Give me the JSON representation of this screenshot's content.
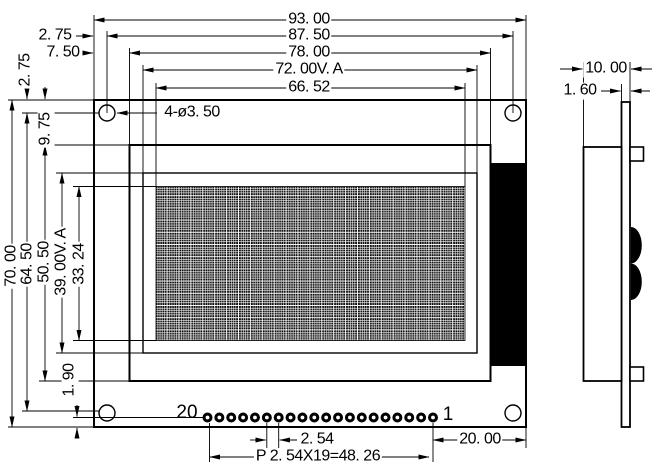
{
  "front": {
    "width_overall": "93. 00",
    "width_holes": "87. 50",
    "width_bezel": "78. 00",
    "width_va": "72. 00V. A",
    "width_aa": "66. 52",
    "offset_edge_hole_h": "2. 75",
    "offset_edge_bezel_h": "7. 50",
    "height_overall": "70. 00",
    "height_holes": "64. 50",
    "height_bezel": "50. 50",
    "height_va": "39. 00V. A",
    "height_aa": "33. 24",
    "offset_edge_hole_v": "2. 75",
    "offset_edge_bezel_v": "9. 75",
    "offset_pins_edge": "1. 90",
    "hole_callout": "4-ø3. 50",
    "pin_first": "20",
    "pin_last": "1",
    "pin_pitch": "2. 54",
    "pin_row_total": "P 2. 54X19=48. 26",
    "pin_end_margin": "20. 00",
    "pin_count": 20
  },
  "side": {
    "thickness_total": "10. 00",
    "thickness_pcb": "1. 60"
  },
  "colors": {
    "ink": "#000000",
    "paper": "#ffffff"
  }
}
